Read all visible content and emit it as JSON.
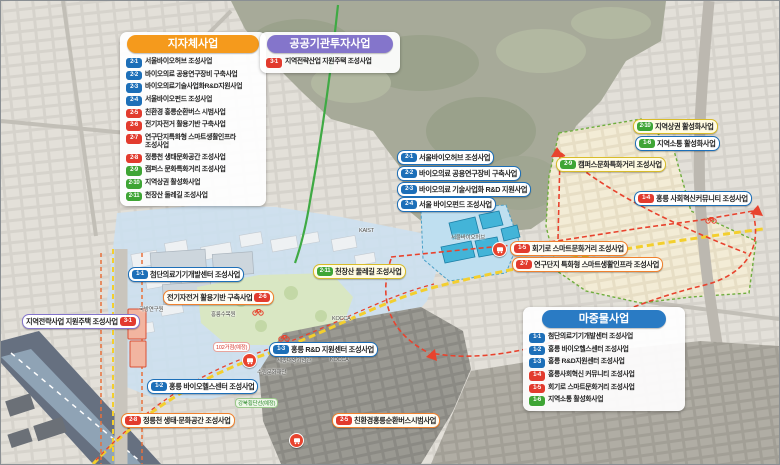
{
  "colors": {
    "local_header": "#f59a1c",
    "public_header": "#8475cb",
    "seed_header": "#2a7bc4",
    "badge_blue": "#1d6fb8",
    "badge_red": "#e23b2e",
    "badge_green": "#3fa535",
    "pill_orange": "#f0812e",
    "pill_yellow": "#d8bc2a",
    "route_red": "#e8432e",
    "road_yellow": "#f3cf2e",
    "trail_green": "#3faa44"
  },
  "legends": {
    "local": {
      "title": "지자체사업",
      "items": [
        {
          "id": "2-1",
          "badge": "blue",
          "label": "서울바이오허브 조성사업"
        },
        {
          "id": "2-2",
          "badge": "blue",
          "label": "바이오의료 공용연구장비 구축사업"
        },
        {
          "id": "2-3",
          "badge": "blue",
          "label": "바이오의료기술사업화R&D지원사업"
        },
        {
          "id": "2-4",
          "badge": "blue",
          "label": "서울바이오펀드 조성사업"
        },
        {
          "id": "2-5",
          "badge": "red",
          "label": "친환경 홍릉순환버스 시범사업"
        },
        {
          "id": "2-6",
          "badge": "red",
          "label": "전기자전거 활용기반 구축사업"
        },
        {
          "id": "2-7",
          "badge": "red",
          "label": "연구단지특화형 스마트생활인프라 조성사업"
        },
        {
          "id": "2-8",
          "badge": "red",
          "label": "정릉천 생태문화공간 조성사업"
        },
        {
          "id": "2-9",
          "badge": "green",
          "label": "캠퍼스 문화특화거리 조성사업"
        },
        {
          "id": "2-10",
          "badge": "green",
          "label": "지역상권 활성화사업"
        },
        {
          "id": "2-11",
          "badge": "green",
          "label": "천장산 둘레길 조성사업"
        }
      ]
    },
    "public": {
      "title": "공공기관투자사업",
      "items": [
        {
          "id": "3-1",
          "badge": "red",
          "label": "지역전략산업 지원주택 조성사업"
        }
      ]
    },
    "seed": {
      "title": "마중물사업",
      "items": [
        {
          "id": "1-1",
          "badge": "blue",
          "label": "첨단의료기기개발센터 조성사업"
        },
        {
          "id": "1-2",
          "badge": "blue",
          "label": "홍릉 바이오헬스센터 조성사업"
        },
        {
          "id": "1-3",
          "badge": "blue",
          "label": "홍릉 R&D지원센터 조성사업"
        },
        {
          "id": "1-4",
          "badge": "red",
          "label": "홍릉사회혁신 커뮤니티 조성사업"
        },
        {
          "id": "1-5",
          "badge": "red",
          "label": "회기로 스마트문화거리 조성사업"
        },
        {
          "id": "1-6",
          "badge": "green",
          "label": "지역소통 활성화사업"
        }
      ]
    }
  },
  "map_labels": [
    {
      "id": "2-1",
      "badge": "blue",
      "style": "blue",
      "label": "서울바이오허브 조성사업"
    },
    {
      "id": "2-2",
      "badge": "blue",
      "style": "blue",
      "label": "바이오의료 공용연구장비 구축사업"
    },
    {
      "id": "2-3",
      "badge": "blue",
      "style": "blue",
      "label": "바이오의료 기술사업화 R&D 지원사업"
    },
    {
      "id": "2-4",
      "badge": "blue",
      "style": "blue",
      "label": "서울 바이오펀드 조성사업"
    },
    {
      "id": "1-1",
      "badge": "blue",
      "style": "blue",
      "label": "첨단의료기기개발센터 조성사업"
    },
    {
      "id": "2-6",
      "badge": "red",
      "style": "orange",
      "label": "전기자전거 활용기반 구축사업"
    },
    {
      "id": "3-1",
      "badge": "red",
      "style": "purple",
      "label": "지역전략사업 지원주택 조성사업"
    },
    {
      "id": "2-11",
      "badge": "green",
      "style": "yellow",
      "label": "천장산 둘레길 조성사업"
    },
    {
      "id": "2-9",
      "badge": "green",
      "style": "yellow",
      "label": "캠퍼스문화특화거리 조성사업"
    },
    {
      "id": "2-10",
      "badge": "green",
      "style": "yellow",
      "label": "지역상권 활성화사업"
    },
    {
      "id": "1-6",
      "badge": "green",
      "style": "blue",
      "label": "지역소통 활성화사업"
    },
    {
      "id": "1-4",
      "badge": "red",
      "style": "blue",
      "label": "홍릉 사회혁신커뮤니티 조성사업"
    },
    {
      "id": "1-5",
      "badge": "red",
      "style": "orange",
      "label": "회기로 스마트문화거리 조성사업"
    },
    {
      "id": "2-7",
      "badge": "red",
      "style": "orange",
      "label": "연구단지 특화형 스마트생활인프라 조성사업"
    },
    {
      "id": "1-3",
      "badge": "blue",
      "style": "blue",
      "label": "홍릉 R&D 지원센터 조성사업"
    },
    {
      "id": "1-2",
      "badge": "blue",
      "style": "blue",
      "label": "홍릉 바이오헬스센터 조성사업"
    },
    {
      "id": "2-8",
      "badge": "red",
      "style": "orange",
      "label": "정릉천 생태·문화공간 조성사업"
    },
    {
      "id": "2-5",
      "badge": "red",
      "style": "orange",
      "label": "친환경홍릉순환버스시범사업"
    }
  ],
  "small_labels": [
    {
      "text": "102거점(예정)",
      "style": "red"
    },
    {
      "text": "강북횡단선(예정)",
      "style": "green"
    },
    {
      "text": "서울바이오허브",
      "style": "gray"
    },
    {
      "text": "홍릉수목원",
      "style": "gray"
    },
    {
      "text": "국방연구원",
      "style": "gray"
    },
    {
      "text": "세종대왕기념관",
      "style": "gray"
    },
    {
      "text": "수림문화재단",
      "style": "gray"
    },
    {
      "text": "KAIST",
      "style": "gray"
    },
    {
      "text": "KOCCA",
      "style": "gray"
    },
    {
      "text": "KOCCA",
      "style": "gray"
    }
  ]
}
